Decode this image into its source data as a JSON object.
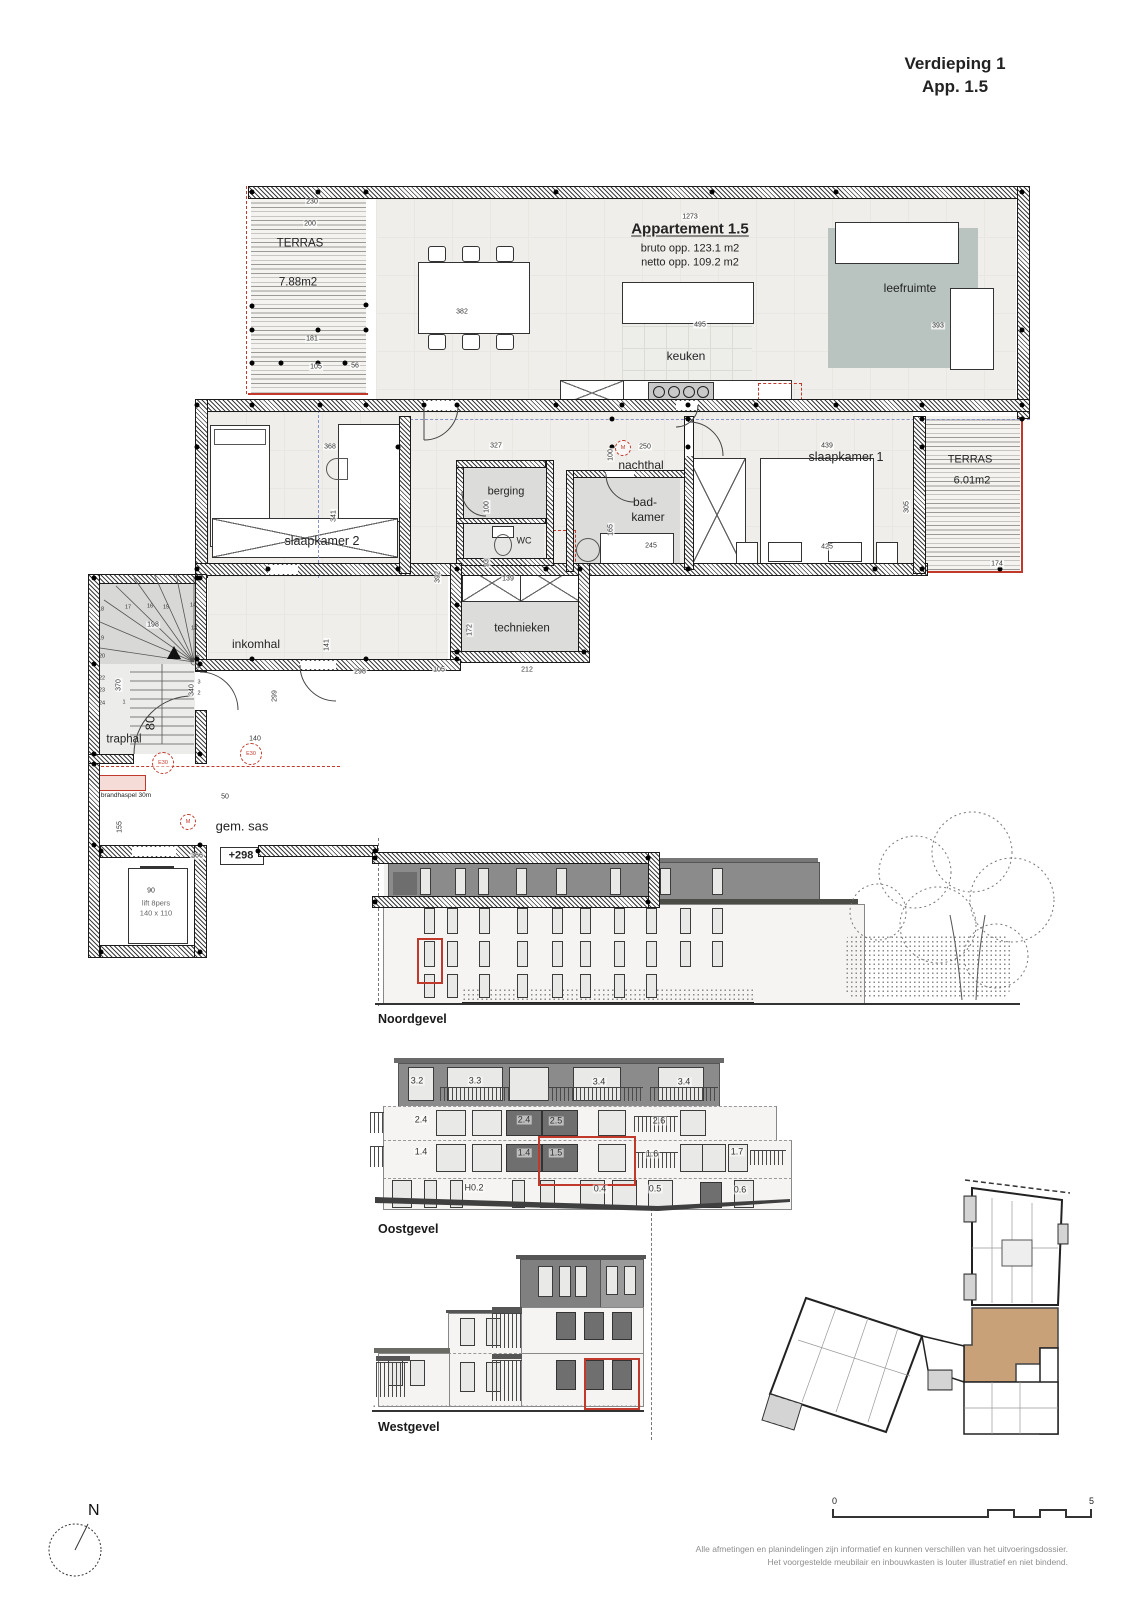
{
  "title": {
    "line1": "Verdieping 1",
    "line2": "App. 1.5"
  },
  "plan": {
    "apartment_name": "Appartement 1.5",
    "bruto_opp": "bruto opp. 123.1 m2",
    "netto_opp": "netto opp. 109.2 m2",
    "rooms": {
      "terras_nw_label": "TERRAS",
      "terras_nw_area": "7.88m2",
      "leefruimte": "leefruimte",
      "keuken": "keuken",
      "slaapkamer2": "slaapkamer 2",
      "nachthal": "nachthal",
      "berging": "berging",
      "wc": "WC",
      "badkamer_line1": "bad-",
      "badkamer_line2": "kamer",
      "slaapkamer1": "slaapkamer 1",
      "terras_e_label": "TERRAS",
      "terras_e_area": "6.01m2",
      "inkomhal": "inkomhal",
      "technieken": "technieken",
      "traphal": "traphal",
      "gem_sas": "gem. sas",
      "lift_line1": "lift 8pers",
      "lift_line2": "140 x 110"
    },
    "markers": {
      "e30": "E30",
      "m": "M",
      "level": "+298",
      "brandhaspel": "brandhaspel 30m",
      "stair_width": "80"
    },
    "dims": [
      "230",
      "200",
      "1273",
      "181",
      "105",
      "56",
      "382",
      "495",
      "393",
      "368",
      "341",
      "327",
      "250",
      "100",
      "439",
      "425",
      "305",
      "174",
      "165",
      "245",
      "93",
      "100",
      "139",
      "392",
      "172",
      "212",
      "105",
      "298",
      "299",
      "141",
      "140",
      "198",
      "370",
      "340",
      "155",
      "50",
      "366",
      "90"
    ],
    "stair_steps": [
      "18",
      "17",
      "16",
      "15",
      "14",
      "13",
      "19",
      "20",
      "22",
      "23",
      "24",
      "5",
      "4",
      "3",
      "2",
      "1"
    ]
  },
  "elevations": {
    "noord": {
      "label": "Noordgevel"
    },
    "oost": {
      "label": "Oostgevel",
      "units_floor3": [
        "3.2",
        "3.3",
        "3.4",
        "3.4"
      ],
      "units_floor2": [
        "2.4",
        "2.4",
        "2.5",
        "2.6"
      ],
      "units_floor1": [
        "1.4",
        "1.4",
        "1.5",
        "1.6",
        "1.7"
      ],
      "units_ground": [
        "H0.2",
        "0.4",
        "0.5",
        "0.6"
      ]
    },
    "west": {
      "label": "Westgevel"
    }
  },
  "key_plan": {
    "highlight_color": "#c9a178"
  },
  "north_indicator": {
    "label": "N"
  },
  "scale_bar": {
    "start": "0",
    "end": "5"
  },
  "footer": {
    "line1": "Alle afmetingen en planindelingen zijn informatief en kunnen verschillen van het uitvoeringsdossier.",
    "line2": "Het voorgestelde meubilair en inbouwkasten is louter illustratief en niet bindend."
  }
}
